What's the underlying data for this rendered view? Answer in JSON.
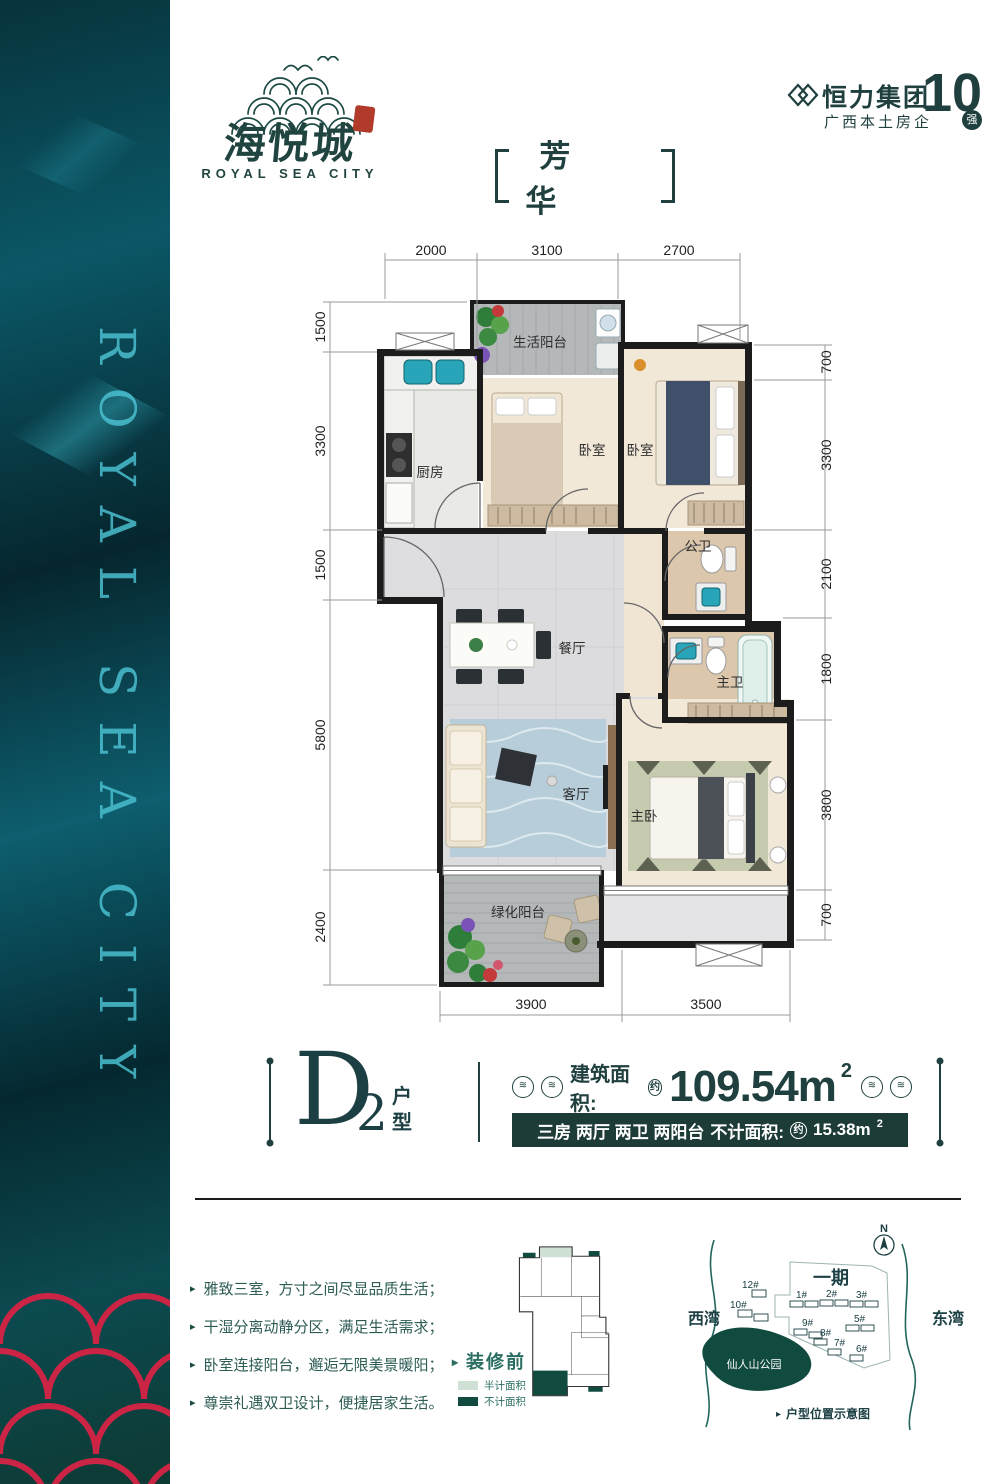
{
  "banner": {
    "vertical_text": "ROYAL SEA CITY"
  },
  "logo": {
    "cn": "海悦城",
    "en": "ROYAL SEA CITY"
  },
  "developer": {
    "name": "恒力集团",
    "tagline": "广西本土房企",
    "rank_number": "10",
    "rank_word": "强"
  },
  "title": {
    "text": "芳 华"
  },
  "floorplan": {
    "rooms": {
      "life_balcony": "生活阳台",
      "kitchen": "厨房",
      "bedroom_a": "卧室",
      "bedroom_b": "卧室",
      "guest_bath": "公卫",
      "dining": "餐厅",
      "master_bath": "主卫",
      "living": "客厅",
      "master_bedroom": "主卧",
      "green_balcony": "绿化阳台"
    },
    "dims_top": [
      "2000",
      "3100",
      "2700"
    ],
    "dims_bottom": [
      "3900",
      "3500"
    ],
    "dims_left": [
      "1500",
      "3300",
      "1500",
      "5800",
      "2400"
    ],
    "dims_right": [
      "700",
      "3300",
      "2100",
      "1800",
      "3800",
      "700"
    ]
  },
  "unit": {
    "letter": "D",
    "number": "2",
    "type_label": "户型",
    "area_label": "建筑面积:",
    "approx": "约",
    "area_value": "109.54m",
    "area_sup": "2",
    "spec": "三房 两厅 两卫 两阳台",
    "excl_label": "不计面积:",
    "excl_approx": "约",
    "excl_value": "15.38m",
    "excl_sup": "2"
  },
  "features": [
    "雅致三室，方寸之间尽显品质生活；",
    "干湿分离动静分区，满足生活需求；",
    "卧室连接阳台，邂逅无限美景暖阳；",
    "尊崇礼遇双卫设计，便捷居家生活。"
  ],
  "mini_plan": {
    "marker": "装修前",
    "legend_half": "半计面积",
    "legend_none": "不计面积"
  },
  "map": {
    "compass": "N",
    "phase": "一期",
    "west_bay": "西湾",
    "east_bay": "东湾",
    "park": "仙人山公园",
    "caption": "户型位置示意图",
    "buildings": [
      "12#",
      "10#",
      "1#",
      "2#",
      "3#",
      "9#",
      "8#",
      "5#",
      "7#",
      "6#"
    ]
  },
  "icons": {
    "wave_circle": "≋",
    "arrow": "▸"
  },
  "colors": {
    "accent": "#203f3f",
    "band": "#1d3c38",
    "scale_red": "#cc2445",
    "seal_red": "#b13a2b",
    "legend_half": "#cfe0d5",
    "legend_none": "#114a3f"
  }
}
